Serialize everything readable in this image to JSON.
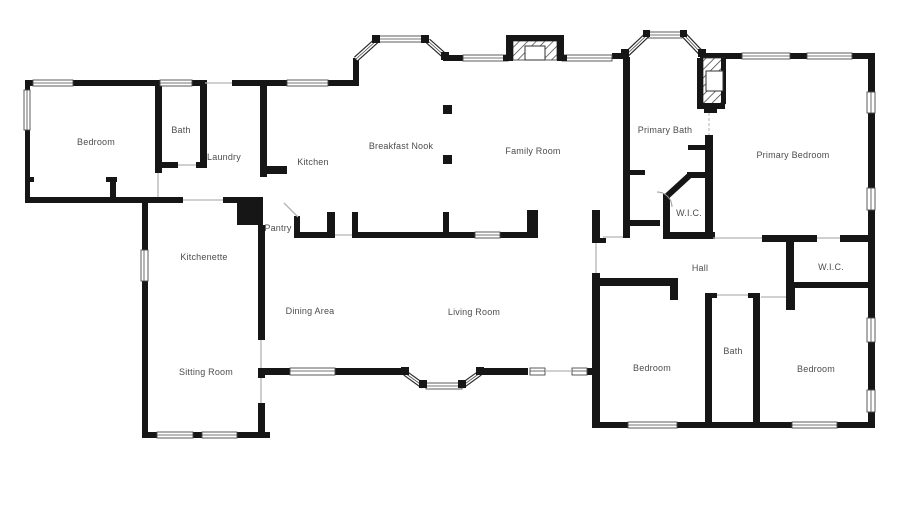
{
  "document": {
    "type": "residential-floor-plan"
  },
  "colors": {
    "wall": "#161616",
    "background": "#ffffff",
    "label_text": "#4d4d4d",
    "window_stroke": "#4a4a4a",
    "door_line": "#b3b3b3"
  },
  "rooms": {
    "bedroom_top_left": {
      "label": "Bedroom"
    },
    "bath_top_left": {
      "label": "Bath"
    },
    "laundry": {
      "label": "Laundry"
    },
    "kitchen": {
      "label": "Kitchen"
    },
    "breakfast_nook": {
      "label": "Breakfast Nook"
    },
    "family_room": {
      "label": "Family Room"
    },
    "primary_bath": {
      "label": "Primary Bath"
    },
    "primary_wic": {
      "label": "W.I.C."
    },
    "primary_bedroom": {
      "label": "Primary Bedroom"
    },
    "pantry": {
      "label": "Pantry"
    },
    "kitchenette": {
      "label": "Kitchenette"
    },
    "hall": {
      "label": "Hall"
    },
    "wic_right": {
      "label": "W.I.C."
    },
    "dining_area": {
      "label": "Dining Area"
    },
    "living_room": {
      "label": "Living Room"
    },
    "sitting_room": {
      "label": "Sitting Room"
    },
    "bedroom_bottom_middle": {
      "label": "Bedroom"
    },
    "bath_bottom": {
      "label": "Bath"
    },
    "bedroom_bottom_right": {
      "label": "Bedroom"
    }
  }
}
